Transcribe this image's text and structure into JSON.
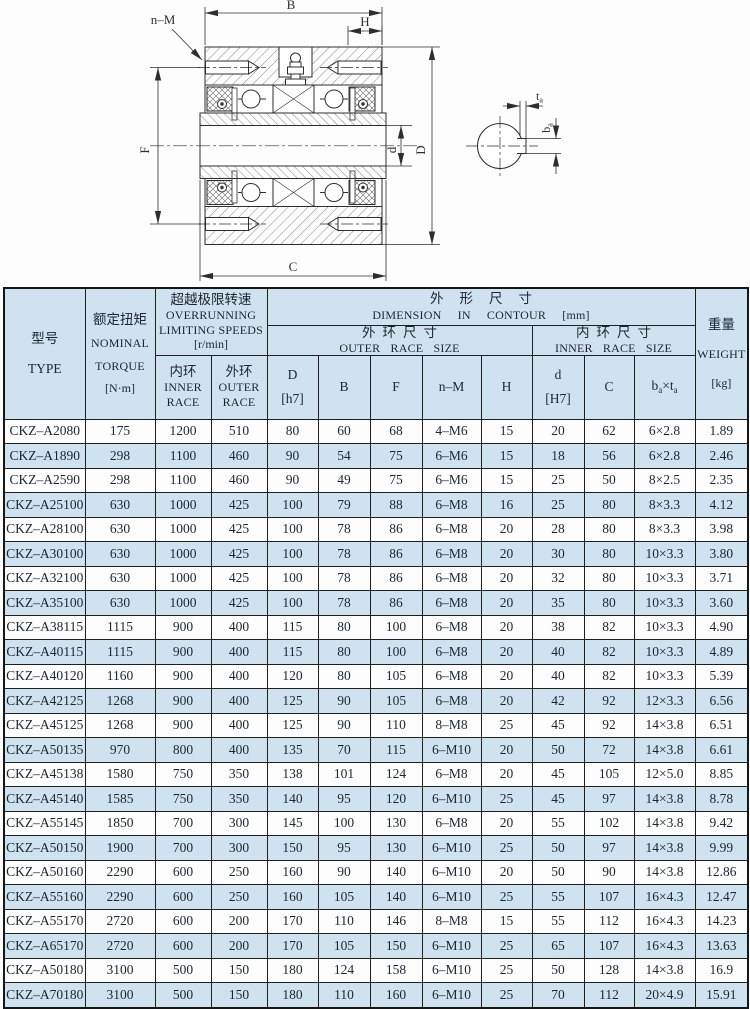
{
  "colors": {
    "row_alt_bg": "#cfe2ef",
    "header_bg": "#cfe2ef",
    "text": "#1c2633",
    "border": "#1f1f1f",
    "drawing_line": "#2e2e2e"
  },
  "drawing": {
    "labels": {
      "B": "B",
      "H": "H",
      "nM": "n–M",
      "F": "F",
      "d": "d",
      "D": "D",
      "C": "C",
      "ta_main": "t",
      "ta_sub": "a",
      "ba_main": "b",
      "ba_sub": "a"
    }
  },
  "table": {
    "header": {
      "type_zh": "型号",
      "type_en": "TYPE",
      "torque_zh": "额定扭矩",
      "torque_en1": "NOMINAL",
      "torque_en2": "TORQUE",
      "torque_unit": "[N·m]",
      "speeds_zh": "超越极限转速",
      "speeds_en1": "OVERRUNNING",
      "speeds_en2": "LIMITING SPEEDS",
      "speeds_unit": "[r/min]",
      "inner_zh": "内环",
      "inner_en1": "INNER",
      "inner_en2": "RACE",
      "outer_zh": "外环",
      "outer_en1": "OUTER",
      "outer_en2": "RACE",
      "dim_zh": "外形尺寸",
      "dim_en": "DIMENSION IN CONTOUR",
      "dim_unit": "[mm]",
      "outer_size_zh": "外环尺寸",
      "outer_size_en": "OUTER RACE SIZE",
      "inner_size_zh": "内环尺寸",
      "inner_size_en": "INNER RACE SIZE",
      "col_D": "D",
      "col_D_unit": "[h7]",
      "col_B": "B",
      "col_F": "F",
      "col_nM": "n–M",
      "col_H": "H",
      "col_d": "d",
      "col_d_unit": "[H7]",
      "col_C": "C",
      "bt_b": "b",
      "bt_bsub": "a",
      "bt_times": "×",
      "bt_t": "t",
      "bt_tsub": "a",
      "weight_zh": "重量",
      "weight_en": "WEIGHT",
      "weight_unit": "[kg]"
    },
    "rows": [
      [
        "CKZ–A2080",
        "175",
        "1200",
        "510",
        "80",
        "60",
        "68",
        "4–M6",
        "15",
        "20",
        "62",
        "6×2.8",
        "1.89"
      ],
      [
        "CKZ–A1890",
        "298",
        "1100",
        "460",
        "90",
        "54",
        "75",
        "6–M6",
        "15",
        "18",
        "56",
        "6×2.8",
        "2.46"
      ],
      [
        "CKZ–A2590",
        "298",
        "1100",
        "460",
        "90",
        "49",
        "75",
        "6–M6",
        "15",
        "25",
        "50",
        "8×2.5",
        "2.35"
      ],
      [
        "CKZ–A25100",
        "630",
        "1000",
        "425",
        "100",
        "79",
        "88",
        "6–M8",
        "16",
        "25",
        "80",
        "8×3.3",
        "4.12"
      ],
      [
        "CKZ–A28100",
        "630",
        "1000",
        "425",
        "100",
        "78",
        "86",
        "6–M8",
        "20",
        "28",
        "80",
        "8×3.3",
        "3.98"
      ],
      [
        "CKZ–A30100",
        "630",
        "1000",
        "425",
        "100",
        "78",
        "86",
        "6–M8",
        "20",
        "30",
        "80",
        "10×3.3",
        "3.80"
      ],
      [
        "CKZ–A32100",
        "630",
        "1000",
        "425",
        "100",
        "78",
        "86",
        "6–M8",
        "20",
        "32",
        "80",
        "10×3.3",
        "3.71"
      ],
      [
        "CKZ–A35100",
        "630",
        "1000",
        "425",
        "100",
        "78",
        "86",
        "6–M8",
        "20",
        "35",
        "80",
        "10×3.3",
        "3.60"
      ],
      [
        "CKZ–A38115",
        "1115",
        "900",
        "400",
        "115",
        "80",
        "100",
        "6–M8",
        "20",
        "38",
        "82",
        "10×3.3",
        "4.90"
      ],
      [
        "CKZ–A40115",
        "1115",
        "900",
        "400",
        "115",
        "80",
        "100",
        "6–M8",
        "20",
        "40",
        "82",
        "10×3.3",
        "4.89"
      ],
      [
        "CKZ–A40120",
        "1160",
        "900",
        "400",
        "120",
        "80",
        "105",
        "6–M8",
        "20",
        "40",
        "82",
        "10×3.3",
        "5.39"
      ],
      [
        "CKZ–A42125",
        "1268",
        "900",
        "400",
        "125",
        "90",
        "105",
        "6–M8",
        "20",
        "42",
        "92",
        "12×3.3",
        "6.56"
      ],
      [
        "CKZ–A45125",
        "1268",
        "900",
        "400",
        "125",
        "90",
        "110",
        "8–M8",
        "25",
        "45",
        "92",
        "14×3.8",
        "6.51"
      ],
      [
        "CKZ–A50135",
        "970",
        "800",
        "400",
        "135",
        "70",
        "115",
        "6–M10",
        "20",
        "50",
        "72",
        "14×3.8",
        "6.61"
      ],
      [
        "CKZ–A45138",
        "1580",
        "750",
        "350",
        "138",
        "101",
        "124",
        "6–M8",
        "20",
        "45",
        "105",
        "12×5.0",
        "8.85"
      ],
      [
        "CKZ–A45140",
        "1585",
        "750",
        "350",
        "140",
        "95",
        "120",
        "6–M10",
        "25",
        "45",
        "97",
        "14×3.8",
        "8.78"
      ],
      [
        "CKZ–A55145",
        "1850",
        "700",
        "300",
        "145",
        "100",
        "130",
        "6–M8",
        "20",
        "55",
        "102",
        "14×3.8",
        "9.42"
      ],
      [
        "CKZ–A50150",
        "1900",
        "700",
        "300",
        "150",
        "95",
        "130",
        "6–M10",
        "25",
        "50",
        "97",
        "14×3.8",
        "9.99"
      ],
      [
        "CKZ–A50160",
        "2290",
        "600",
        "250",
        "160",
        "90",
        "140",
        "6–M10",
        "20",
        "50",
        "90",
        "14×3.8",
        "12.86"
      ],
      [
        "CKZ–A55160",
        "2290",
        "600",
        "250",
        "160",
        "105",
        "140",
        "6–M10",
        "25",
        "55",
        "107",
        "16×4.3",
        "12.47"
      ],
      [
        "CKZ–A55170",
        "2720",
        "600",
        "200",
        "170",
        "110",
        "146",
        "8–M8",
        "15",
        "55",
        "112",
        "16×4.3",
        "14.23"
      ],
      [
        "CKZ–A65170",
        "2720",
        "600",
        "200",
        "170",
        "105",
        "150",
        "6–M10",
        "25",
        "65",
        "107",
        "16×4.3",
        "13.63"
      ],
      [
        "CKZ–A50180",
        "3100",
        "500",
        "150",
        "180",
        "124",
        "158",
        "6–M10",
        "25",
        "50",
        "128",
        "14×3.8",
        "16.9"
      ],
      [
        "CKZ–A70180",
        "3100",
        "500",
        "150",
        "180",
        "110",
        "160",
        "6–M10",
        "25",
        "70",
        "112",
        "20×4.9",
        "15.91"
      ]
    ]
  }
}
